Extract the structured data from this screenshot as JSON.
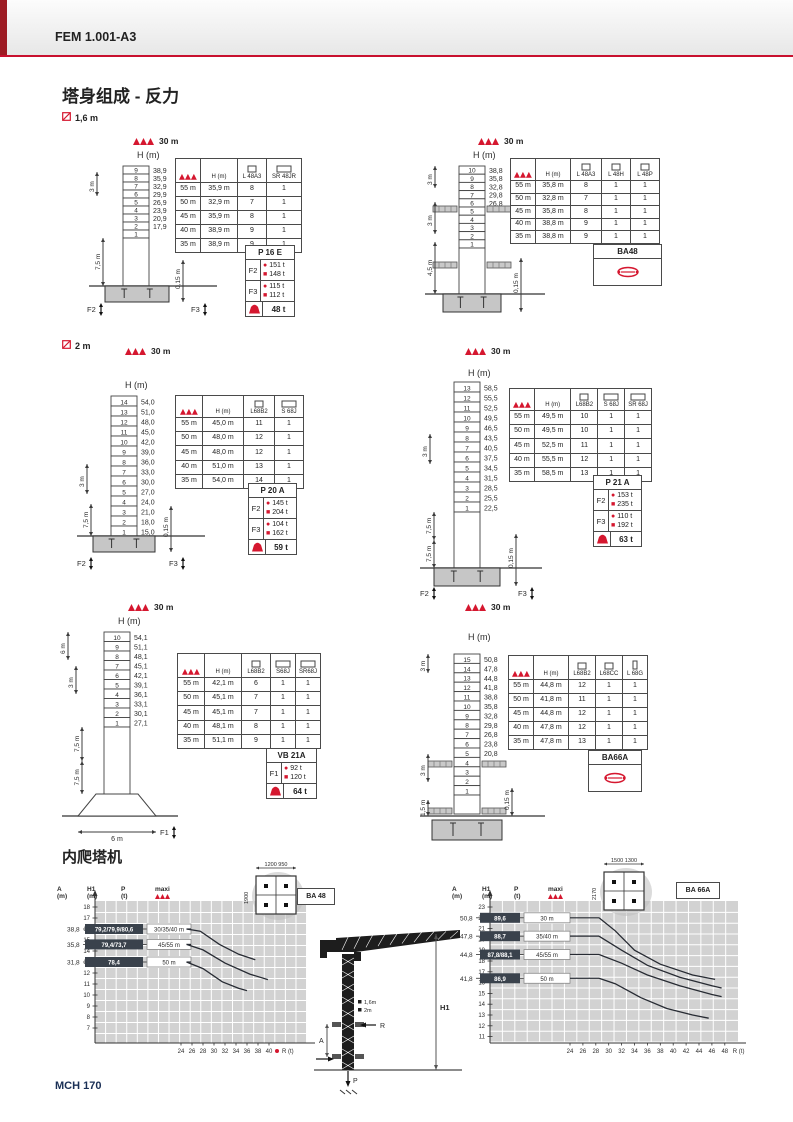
{
  "page": {
    "header": "FEM 1.001-A3",
    "title": "塔身组成 - 反力",
    "footer": "MCH 170",
    "climb_title": "内爬塔机",
    "mast_label_16": "1,6 m",
    "mast_label_2": "2 m",
    "accent_color": "#c8102e"
  },
  "diagrams": [
    {
      "id": "d1",
      "jib": "30 m",
      "h_title": "H (m)",
      "sections": [
        [
          "9",
          "38,9"
        ],
        [
          "8",
          "35,9"
        ],
        [
          "7",
          "32,9"
        ],
        [
          "6",
          "29,9"
        ],
        [
          "5",
          "26,9"
        ],
        [
          "4",
          "23,9"
        ],
        [
          "3",
          "20,9"
        ],
        [
          "2",
          "17,9"
        ],
        [
          "1",
          ""
        ]
      ],
      "dims": [
        "3 m",
        "7,5 m",
        "0,15 m"
      ],
      "forces": [
        "F2",
        "F3"
      ],
      "table": {
        "headers": [
          {
            "icon": "jib",
            "label": ""
          },
          {
            "icon": "",
            "label": "H (m)"
          },
          {
            "icon": "square",
            "label": "L 48A3"
          },
          {
            "icon": "rect",
            "label": "SR 48JR"
          }
        ],
        "rows": [
          [
            "55 m",
            "35,9 m",
            "8",
            "1"
          ],
          [
            "50 m",
            "32,9 m",
            "7",
            "1"
          ],
          [
            "45 m",
            "35,9 m",
            "8",
            "1"
          ],
          [
            "40 m",
            "38,9 m",
            "9",
            "1"
          ],
          [
            "35 m",
            "38,9 m",
            "9",
            "1"
          ]
        ]
      },
      "box": {
        "type": "forces",
        "title": "P 16 E",
        "rows": [
          {
            "label": "F2",
            "dot": "151 t",
            "sq": "148 t"
          },
          {
            "label": "F3",
            "dot": "115 t",
            "sq": "112 t"
          }
        ],
        "ballast": "48 t"
      }
    },
    {
      "id": "d2",
      "jib": "30 m",
      "h_title": "H (m)",
      "sections": [
        [
          "10",
          "38,8"
        ],
        [
          "9",
          "35,8"
        ],
        [
          "8",
          "32,8"
        ],
        [
          "7",
          "29,8"
        ],
        [
          "6",
          "26,8"
        ],
        [
          "5",
          ""
        ],
        [
          "4",
          ""
        ],
        [
          "3",
          ""
        ],
        [
          "2",
          ""
        ],
        [
          "1",
          ""
        ]
      ],
      "dims": [
        "3 m",
        "3 m",
        "4,5 m",
        "0,15 m"
      ],
      "forces": [],
      "table": {
        "headers": [
          {
            "icon": "jib",
            "label": ""
          },
          {
            "icon": "",
            "label": "H (m)"
          },
          {
            "icon": "square",
            "label": "L 48A3"
          },
          {
            "icon": "square",
            "label": "L 48H"
          },
          {
            "icon": "square",
            "label": "L 48P"
          }
        ],
        "rows": [
          [
            "55 m",
            "35,8 m",
            "8",
            "1",
            "1"
          ],
          [
            "50 m",
            "32,8 m",
            "7",
            "1",
            "1"
          ],
          [
            "45 m",
            "35,8 m",
            "8",
            "1",
            "1"
          ],
          [
            "40 m",
            "38,8 m",
            "9",
            "1",
            "1"
          ],
          [
            "35 m",
            "38,8 m",
            "9",
            "1",
            "1"
          ]
        ]
      },
      "box": {
        "type": "anchor",
        "title": "BA48"
      }
    },
    {
      "id": "d3",
      "jib": "30 m",
      "h_title": "H (m)",
      "sections": [
        [
          "14",
          "54,0"
        ],
        [
          "13",
          "51,0"
        ],
        [
          "12",
          "48,0"
        ],
        [
          "11",
          "45,0"
        ],
        [
          "10",
          "42,0"
        ],
        [
          "9",
          "39,0"
        ],
        [
          "8",
          "36,0"
        ],
        [
          "7",
          "33,0"
        ],
        [
          "6",
          "30,0"
        ],
        [
          "5",
          "27,0"
        ],
        [
          "4",
          "24,0"
        ],
        [
          "3",
          "21,0"
        ],
        [
          "2",
          "18,0"
        ],
        [
          "1",
          "15,0"
        ]
      ],
      "dims": [
        "3 m",
        "7,5 m",
        "0,15 m"
      ],
      "forces": [
        "F2",
        "F3"
      ],
      "table": {
        "headers": [
          {
            "icon": "jib",
            "label": ""
          },
          {
            "icon": "",
            "label": "H (m)"
          },
          {
            "icon": "square",
            "label": "L68B2"
          },
          {
            "icon": "rect",
            "label": "S 68J"
          }
        ],
        "rows": [
          [
            "55 m",
            "45,0 m",
            "11",
            "1"
          ],
          [
            "50 m",
            "48,0 m",
            "12",
            "1"
          ],
          [
            "45 m",
            "48,0 m",
            "12",
            "1"
          ],
          [
            "40 m",
            "51,0 m",
            "13",
            "1"
          ],
          [
            "35 m",
            "54,0 m",
            "14",
            "1"
          ]
        ]
      },
      "box": {
        "type": "forces",
        "title": "P 20 A",
        "rows": [
          {
            "label": "F2",
            "dot": "145 t",
            "sq": "204 t"
          },
          {
            "label": "F3",
            "dot": "104 t",
            "sq": "162 t"
          }
        ],
        "ballast": "59 t"
      }
    },
    {
      "id": "d4",
      "jib": "30 m",
      "h_title": "H (m)",
      "sections": [
        [
          "13",
          "58,5"
        ],
        [
          "12",
          "55,5"
        ],
        [
          "11",
          "52,5"
        ],
        [
          "10",
          "49,5"
        ],
        [
          "9",
          "46,5"
        ],
        [
          "8",
          "43,5"
        ],
        [
          "7",
          "40,5"
        ],
        [
          "6",
          "37,5"
        ],
        [
          "5",
          "34,5"
        ],
        [
          "4",
          "31,5"
        ],
        [
          "3",
          "28,5"
        ],
        [
          "2",
          "25,5"
        ],
        [
          "1",
          "22,5"
        ]
      ],
      "dims": [
        "3 m",
        "7,5 m",
        "7,5 m",
        "0,15 m"
      ],
      "forces": [
        "F2",
        "F3"
      ],
      "table": {
        "headers": [
          {
            "icon": "jib",
            "label": ""
          },
          {
            "icon": "",
            "label": "H (m)"
          },
          {
            "icon": "square",
            "label": "L68B2"
          },
          {
            "icon": "rect",
            "label": "S 68J"
          },
          {
            "icon": "rect",
            "label": "SR 68J"
          }
        ],
        "rows": [
          [
            "55 m",
            "49,5 m",
            "10",
            "1",
            "1"
          ],
          [
            "50 m",
            "49,5 m",
            "10",
            "1",
            "1"
          ],
          [
            "45 m",
            "52,5 m",
            "11",
            "1",
            "1"
          ],
          [
            "40 m",
            "55,5 m",
            "12",
            "1",
            "1"
          ],
          [
            "35 m",
            "58,5 m",
            "13",
            "1",
            "1"
          ]
        ]
      },
      "box": {
        "type": "forces",
        "title": "P 21 A",
        "rows": [
          {
            "label": "F2",
            "dot": "153 t",
            "sq": "235 t"
          },
          {
            "label": "F3",
            "dot": "110 t",
            "sq": "192 t"
          }
        ],
        "ballast": "63 t"
      }
    },
    {
      "id": "d5",
      "jib": "30 m",
      "h_title": "H (m)",
      "sections": [
        [
          "10",
          "54,1"
        ],
        [
          "9",
          "51,1"
        ],
        [
          "8",
          "48,1"
        ],
        [
          "7",
          "45,1"
        ],
        [
          "6",
          "42,1"
        ],
        [
          "5",
          "39,1"
        ],
        [
          "4",
          "36,1"
        ],
        [
          "3",
          "33,1"
        ],
        [
          "2",
          "30,1"
        ],
        [
          "1",
          "27,1"
        ]
      ],
      "dims": [
        "6 m",
        "3 m",
        "7,5 m",
        "7,5 m",
        "6 m"
      ],
      "forces": [
        "F1"
      ],
      "table": {
        "headers": [
          {
            "icon": "jib",
            "label": ""
          },
          {
            "icon": "",
            "label": "H (m)"
          },
          {
            "icon": "square",
            "label": "L68B2"
          },
          {
            "icon": "rect",
            "label": "S68J"
          },
          {
            "icon": "rect",
            "label": "SR68J"
          }
        ],
        "rows": [
          [
            "55 m",
            "42,1 m",
            "6",
            "1",
            "1"
          ],
          [
            "50 m",
            "45,1 m",
            "7",
            "1",
            "1"
          ],
          [
            "45 m",
            "45,1 m",
            "7",
            "1",
            "1"
          ],
          [
            "40 m",
            "48,1 m",
            "8",
            "1",
            "1"
          ],
          [
            "35 m",
            "51,1 m",
            "9",
            "1",
            "1"
          ]
        ]
      },
      "box": {
        "type": "forces",
        "title": "VB 21A",
        "rows": [
          {
            "label": "F1",
            "dot": "92 t",
            "sq": "120 t"
          }
        ],
        "ballast": "64 t"
      }
    },
    {
      "id": "d6",
      "jib": "30 m",
      "h_title": "H (m)",
      "sections": [
        [
          "15",
          "50,8"
        ],
        [
          "14",
          "47,8"
        ],
        [
          "13",
          "44,8"
        ],
        [
          "12",
          "41,8"
        ],
        [
          "11",
          "38,8"
        ],
        [
          "10",
          "35,8"
        ],
        [
          "9",
          "32,8"
        ],
        [
          "8",
          "29,8"
        ],
        [
          "7",
          "26,8"
        ],
        [
          "6",
          "23,8"
        ],
        [
          "5",
          "20,8"
        ],
        [
          "4",
          ""
        ],
        [
          "3",
          ""
        ],
        [
          "2",
          ""
        ],
        [
          "1",
          ""
        ]
      ],
      "dims": [
        "3 m",
        "3 m",
        "1,5 m",
        "0,15 m"
      ],
      "forces": [],
      "table": {
        "headers": [
          {
            "icon": "jib",
            "label": ""
          },
          {
            "icon": "",
            "label": "H (m)"
          },
          {
            "icon": "square",
            "label": "L68B2"
          },
          {
            "icon": "square",
            "label": "L68CC"
          },
          {
            "icon": "narrow",
            "label": "L 68G"
          }
        ],
        "rows": [
          [
            "55 m",
            "44,8 m",
            "12",
            "1",
            "1"
          ],
          [
            "50 m",
            "41,8 m",
            "11",
            "1",
            "1"
          ],
          [
            "45 m",
            "44,8 m",
            "12",
            "1",
            "1"
          ],
          [
            "40 m",
            "47,8 m",
            "12",
            "1",
            "1"
          ],
          [
            "35 m",
            "47,8 m",
            "13",
            "1",
            "1"
          ]
        ]
      },
      "box": {
        "type": "anchor",
        "title": "BA66A"
      }
    }
  ],
  "chart_data": [
    {
      "type": "line",
      "title": "BA 48",
      "col_headers": [
        "A (m)",
        "H1 (m)",
        "P (t)",
        "maxi"
      ],
      "xlabel": "R (t)",
      "ylabel": "A (m)",
      "x_ticks": [
        24,
        26,
        28,
        30,
        32,
        34,
        36,
        38,
        40
      ],
      "y_ticks": [
        18,
        17,
        16,
        15,
        14,
        13,
        12,
        11,
        10,
        9,
        8,
        7
      ],
      "red_dot_on_axis": true,
      "grid": true,
      "footprint": {
        "top": "1200 950",
        "side": "1900",
        "label": "BA 48"
      },
      "rows": [
        {
          "h1": "38,8",
          "p": "79,2/79,9/80,6",
          "maxi": "30/35/40 m",
          "a": 16
        },
        {
          "h1": "35,8",
          "p": "79,4/73,7",
          "maxi": "45/55 m",
          "a": 14.6
        },
        {
          "h1": "31,8",
          "p": "78,4",
          "maxi": "50 m",
          "a": 13
        }
      ],
      "series": [
        {
          "name": "30/35/40 m",
          "points": [
            [
              25,
              16
            ],
            [
              27.5,
              15.8
            ],
            [
              31,
              14.6
            ],
            [
              34.5,
              13.7
            ],
            [
              37.5,
              13.2
            ]
          ]
        },
        {
          "name": "45/55 m",
          "points": [
            [
              25,
              14.6
            ],
            [
              28,
              14.1
            ],
            [
              32,
              12.9
            ],
            [
              36.5,
              11.9
            ],
            [
              39.8,
              11.4
            ]
          ]
        },
        {
          "name": "50 m",
          "points": [
            [
              25,
              13
            ],
            [
              28,
              12.4
            ],
            [
              31.5,
              11.2
            ],
            [
              34.5,
              10.6
            ],
            [
              36,
              10.4
            ]
          ]
        }
      ]
    },
    {
      "type": "line",
      "title": "BA 66A",
      "col_headers": [
        "A (m)",
        "H1 (m)",
        "P (t)",
        "maxi"
      ],
      "xlabel": "R (t)",
      "ylabel": "A (m)",
      "x_ticks": [
        24,
        26,
        28,
        30,
        32,
        34,
        36,
        38,
        40,
        42,
        44,
        46,
        48
      ],
      "y_ticks": [
        23,
        22,
        21,
        20,
        19,
        18,
        17,
        16,
        15,
        14,
        13,
        12,
        11
      ],
      "red_dot_on_axis": false,
      "grid": true,
      "footprint": {
        "top": "1500 1300",
        "side": "2170",
        "label": "BA 66A"
      },
      "rows": [
        {
          "h1": "50,8",
          "p": "89,6",
          "maxi": "30 m",
          "a": 22
        },
        {
          "h1": "47,8",
          "p": "88,7",
          "maxi": "35/40 m",
          "a": 20.3
        },
        {
          "h1": "44,8",
          "p": "87,8/88,1",
          "maxi": "45/55 m",
          "a": 18.6
        },
        {
          "h1": "41,8",
          "p": "86,9",
          "maxi": "50 m",
          "a": 16.4
        }
      ],
      "series": [
        {
          "name": "30 m",
          "points": [
            [
              28.5,
              22
            ],
            [
              31,
              20.8
            ],
            [
              34,
              19
            ],
            [
              38,
              17.7
            ],
            [
              43,
              16.7
            ],
            [
              46.5,
              16.3
            ]
          ]
        },
        {
          "name": "35/40 m",
          "points": [
            [
              28.5,
              20.3
            ],
            [
              32,
              19
            ],
            [
              36,
              17.6
            ],
            [
              41,
              16.5
            ],
            [
              46,
              15.7
            ],
            [
              47.5,
              15.5
            ]
          ]
        },
        {
          "name": "45/55 m",
          "points": [
            [
              28.5,
              18.6
            ],
            [
              32,
              17.8
            ],
            [
              36,
              16.7
            ],
            [
              41,
              15.7
            ],
            [
              46,
              14.9
            ],
            [
              47.5,
              14.7
            ]
          ]
        },
        {
          "name": "50 m",
          "points": [
            [
              28.5,
              16.4
            ],
            [
              31,
              15.9
            ],
            [
              35,
              14.6
            ],
            [
              39,
              13.6
            ],
            [
              43,
              13
            ],
            [
              45.5,
              12.7
            ]
          ]
        }
      ]
    }
  ],
  "crane_figure": {
    "h1": "H1",
    "a": "A",
    "r": "R",
    "p": "P",
    "mast_sizes": [
      "1,6m",
      "2m"
    ]
  }
}
